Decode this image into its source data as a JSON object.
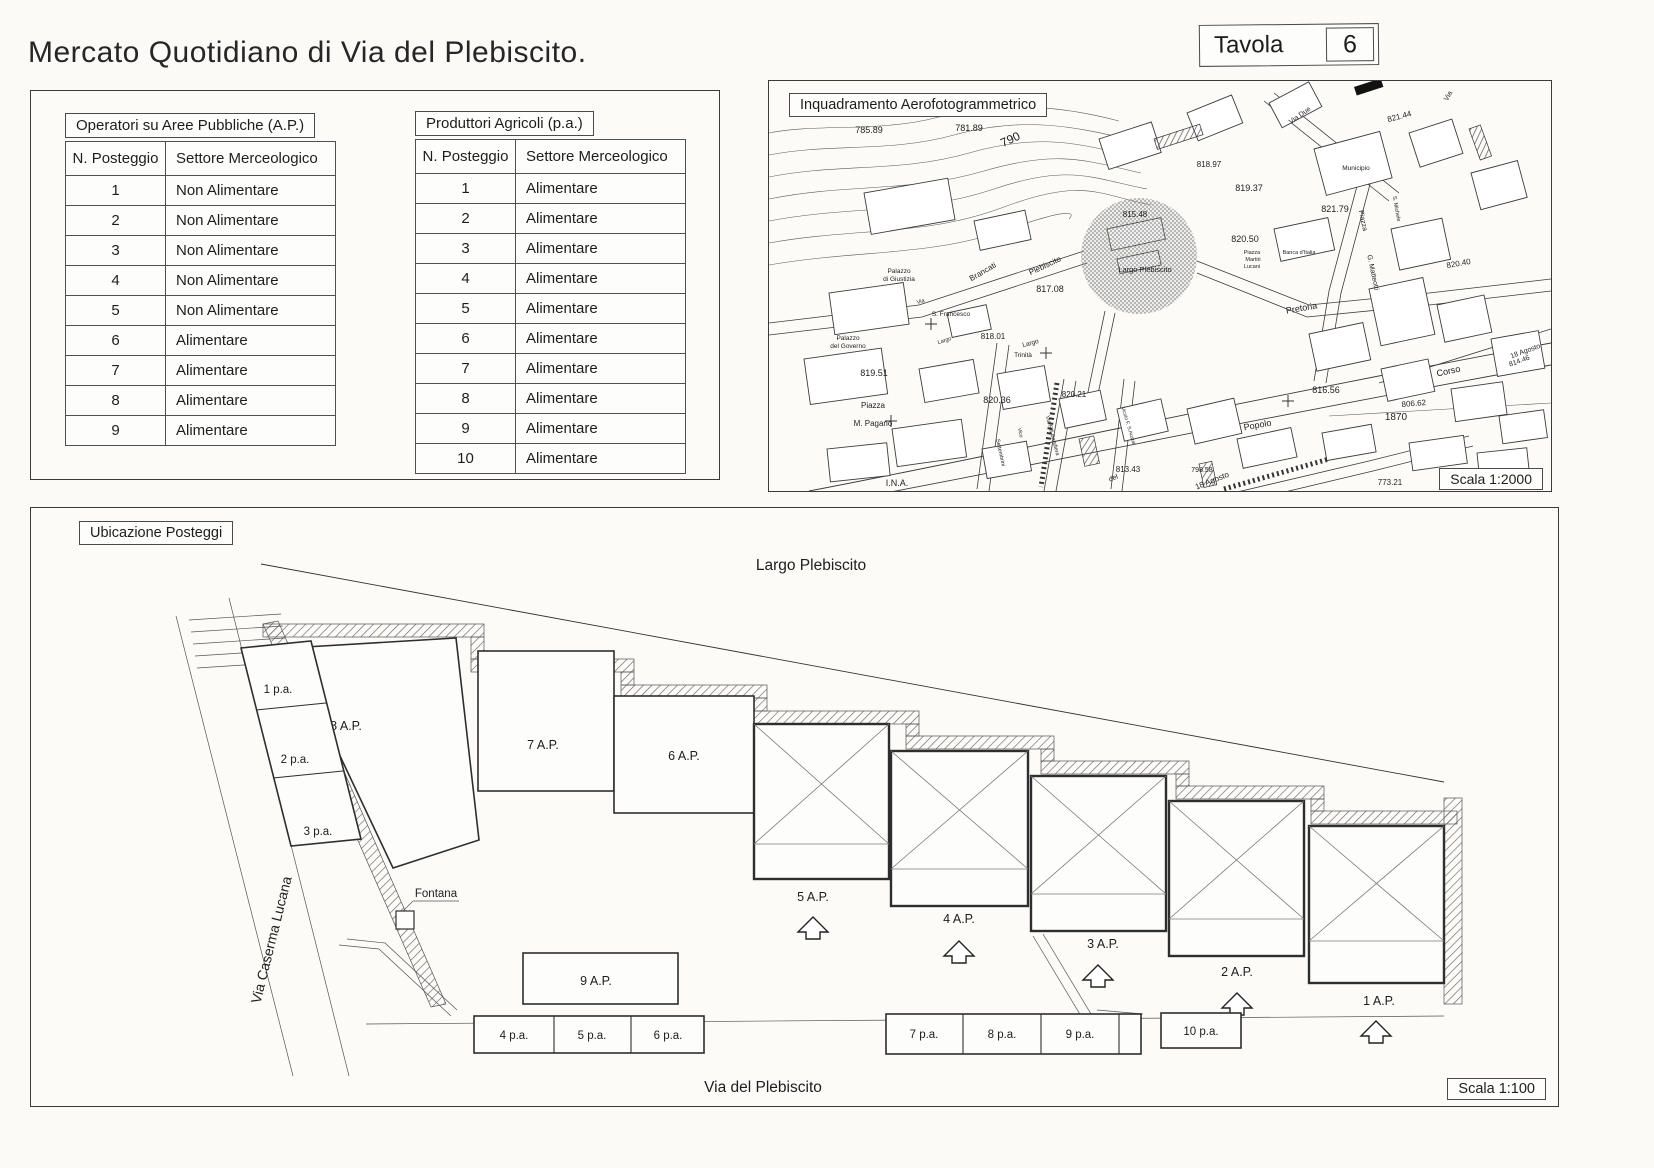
{
  "page": {
    "title": "Mercato Quotidiano di Via del Plebiscito.",
    "tavola_label": "Tavola",
    "tavola_number": "6"
  },
  "colors": {
    "paper": "#fbfaf7",
    "ink": "#1d1d1d"
  },
  "tables": {
    "ap": {
      "title": "Operatori su Aree Pubbliche  (A.P.)",
      "headers": [
        "N. Posteggio",
        "Settore Merceologico"
      ],
      "rows": [
        [
          "1",
          "Non Alimentare"
        ],
        [
          "2",
          "Non Alimentare"
        ],
        [
          "3",
          "Non Alimentare"
        ],
        [
          "4",
          "Non Alimentare"
        ],
        [
          "5",
          "Non Alimentare"
        ],
        [
          "6",
          "Alimentare"
        ],
        [
          "7",
          "Alimentare"
        ],
        [
          "8",
          "Alimentare"
        ],
        [
          "9",
          "Alimentare"
        ]
      ]
    },
    "pa": {
      "title": "Produttori Agricoli  (p.a.)",
      "headers": [
        "N. Posteggio",
        "Settore Merceologico"
      ],
      "rows": [
        [
          "1",
          "Alimentare"
        ],
        [
          "2",
          "Alimentare"
        ],
        [
          "3",
          "Alimentare"
        ],
        [
          "4",
          "Alimentare"
        ],
        [
          "5",
          "Alimentare"
        ],
        [
          "6",
          "Alimentare"
        ],
        [
          "7",
          "Alimentare"
        ],
        [
          "8",
          "Alimentare"
        ],
        [
          "9",
          "Alimentare"
        ],
        [
          "10",
          "Alimentare"
        ]
      ]
    }
  },
  "map": {
    "title": "Inquadramento Aerofotogrammetrico",
    "scale_label": "Scala 1:2000",
    "labels": [
      {
        "t": "785.89",
        "x": 100,
        "y": 52,
        "s": 9
      },
      {
        "t": "781.89",
        "x": 200,
        "y": 50,
        "s": 9
      },
      {
        "t": "790",
        "x": 243,
        "y": 62,
        "s": 12,
        "r": -25
      },
      {
        "t": "818.97",
        "x": 440,
        "y": 86,
        "s": 8
      },
      {
        "t": "819.37",
        "x": 480,
        "y": 110,
        "s": 9
      },
      {
        "t": "815.48",
        "x": 366,
        "y": 136,
        "s": 8
      },
      {
        "t": "820.50",
        "x": 476,
        "y": 161,
        "s": 9
      },
      {
        "t": "Piazza",
        "x": 483,
        "y": 173,
        "s": 5.5
      },
      {
        "t": "Martiri",
        "x": 484,
        "y": 180,
        "s": 5.5
      },
      {
        "t": "Lucani",
        "x": 483,
        "y": 187,
        "s": 5.5
      },
      {
        "t": "Banca d'Italia",
        "x": 530,
        "y": 173,
        "s": 5.5
      },
      {
        "t": "Largo Plebiscito",
        "x": 376,
        "y": 191,
        "s": 7.5
      },
      {
        "t": "Plebiscito",
        "x": 277,
        "y": 187,
        "s": 8,
        "r": -25
      },
      {
        "t": "Brancati",
        "x": 215,
        "y": 193,
        "s": 8,
        "r": -30
      },
      {
        "t": "Palazzo",
        "x": 130,
        "y": 192,
        "s": 6.5
      },
      {
        "t": "di Giustizia",
        "x": 130,
        "y": 200,
        "s": 6.5
      },
      {
        "t": "Via",
        "x": 152,
        "y": 222,
        "s": 5.5,
        "r": -15
      },
      {
        "t": "S. Francesco",
        "x": 182,
        "y": 235,
        "s": 6.5
      },
      {
        "t": "Palazzo",
        "x": 79,
        "y": 259,
        "s": 6.5
      },
      {
        "t": "del Governo",
        "x": 79,
        "y": 267,
        "s": 6.5
      },
      {
        "t": "Largo",
        "x": 176,
        "y": 261,
        "s": 5.5,
        "r": -18
      },
      {
        "t": "818.01",
        "x": 224,
        "y": 258,
        "s": 8
      },
      {
        "t": "Largo",
        "x": 262,
        "y": 264,
        "s": 6.5,
        "r": -15
      },
      {
        "t": "Trinità",
        "x": 254,
        "y": 276,
        "s": 6.5
      },
      {
        "t": "817.08",
        "x": 281,
        "y": 211,
        "s": 9
      },
      {
        "t": "819.51",
        "x": 105,
        "y": 295,
        "s": 9
      },
      {
        "t": "Piazza",
        "x": 104,
        "y": 327,
        "s": 8
      },
      {
        "t": "M. Pagano",
        "x": 104,
        "y": 345,
        "s": 8
      },
      {
        "t": "820.36",
        "x": 228,
        "y": 322,
        "s": 9
      },
      {
        "t": "820.21",
        "x": 305,
        "y": 316,
        "s": 8
      },
      {
        "t": "Via F.lli Bandiera",
        "x": 282,
        "y": 355,
        "s": 5.5,
        "r": 75
      },
      {
        "t": "Vico",
        "x": 250,
        "y": 352,
        "s": 5,
        "r": 78
      },
      {
        "t": "Settembrini",
        "x": 230,
        "y": 372,
        "s": 5.5,
        "r": 78
      },
      {
        "t": "Vicolo F. S.Austai",
        "x": 358,
        "y": 345,
        "s": 5,
        "r": 73
      },
      {
        "t": "813.43",
        "x": 359,
        "y": 391,
        "s": 8
      },
      {
        "t": "del",
        "x": 345,
        "y": 399,
        "s": 7,
        "r": -20
      },
      {
        "t": "Popolo",
        "x": 489,
        "y": 347,
        "s": 9,
        "r": -10
      },
      {
        "t": "816.56",
        "x": 557,
        "y": 312,
        "s": 9
      },
      {
        "t": "806.62",
        "x": 645,
        "y": 325,
        "s": 8,
        "r": -5
      },
      {
        "t": "1870",
        "x": 627,
        "y": 339,
        "s": 10
      },
      {
        "t": "Corso",
        "x": 680,
        "y": 293,
        "s": 9,
        "r": -12
      },
      {
        "t": "18 Agosto",
        "x": 757,
        "y": 272,
        "s": 7,
        "r": -20
      },
      {
        "t": "814.46",
        "x": 751,
        "y": 282,
        "s": 7,
        "r": -20
      },
      {
        "t": "18 Agosto",
        "x": 444,
        "y": 402,
        "s": 8,
        "r": -22
      },
      {
        "t": "798.58",
        "x": 433,
        "y": 391,
        "s": 7
      },
      {
        "t": "773.21",
        "x": 621,
        "y": 404,
        "s": 8
      },
      {
        "t": "I.N.A.",
        "x": 128,
        "y": 405,
        "s": 9
      },
      {
        "t": "Pretoria",
        "x": 533,
        "y": 230,
        "s": 9,
        "r": -10
      },
      {
        "t": "Municipio",
        "x": 587,
        "y": 89,
        "s": 6.5
      },
      {
        "t": "Piazza",
        "x": 592,
        "y": 140,
        "s": 7,
        "r": 78
      },
      {
        "t": "G. Matteotti",
        "x": 602,
        "y": 192,
        "s": 7,
        "r": 78
      },
      {
        "t": "821.79",
        "x": 566,
        "y": 131,
        "s": 9
      },
      {
        "t": "821.44",
        "x": 631,
        "y": 38,
        "s": 8,
        "r": -15
      },
      {
        "t": "820.40",
        "x": 690,
        "y": 185,
        "s": 8,
        "r": -10
      },
      {
        "t": "S. Michele",
        "x": 626,
        "y": 128,
        "s": 5.5,
        "r": 80
      },
      {
        "t": "Via Due",
        "x": 532,
        "y": 36,
        "s": 7,
        "r": -35
      },
      {
        "t": "Via",
        "x": 681,
        "y": 16,
        "s": 7,
        "r": -60
      }
    ]
  },
  "plan": {
    "box_label": "Ubicazione Posteggi",
    "scale_label": "Scala 1:100",
    "largo_label": "Largo Plebiscito",
    "via_bottom_label": "Via del Plebiscito",
    "via_left_label": "Via Caserma Lucana",
    "fountain_label": "Fontana",
    "stalls_plain": [
      {
        "id": "8ap",
        "label": "8 A.P.",
        "poly": [
          [
            258,
            140
          ],
          [
            425,
            130
          ],
          [
            448,
            332
          ],
          [
            362,
            360
          ]
        ],
        "lx": 315,
        "ly": 222
      },
      {
        "id": "7ap",
        "label": "7 A.P.",
        "rect": [
          447,
          143,
          136,
          140
        ],
        "lx": 512,
        "ly": 241
      },
      {
        "id": "6ap",
        "label": "6 A.P.",
        "rect": [
          583,
          188,
          140,
          117
        ],
        "lx": 653,
        "ly": 252
      },
      {
        "id": "9ap",
        "label": "9 A.P.",
        "rect": [
          492,
          445,
          155,
          51
        ],
        "lx": 565,
        "ly": 477
      }
    ],
    "stalls_crossed": [
      {
        "id": "5ap",
        "label": "5 A.P.",
        "rect": [
          723,
          216,
          135,
          155
        ],
        "inner": 336,
        "lx": 782,
        "ly": 393,
        "ax": 782,
        "ay": 418
      },
      {
        "id": "4ap",
        "label": "4 A.P.",
        "rect": [
          860,
          243,
          137,
          155
        ],
        "inner": 361,
        "lx": 928,
        "ly": 415,
        "ax": 928,
        "ay": 442
      },
      {
        "id": "3ap",
        "label": "3 A.P.",
        "rect": [
          1000,
          268,
          135,
          155
        ],
        "inner": 386,
        "lx": 1072,
        "ly": 440,
        "ax": 1067,
        "ay": 466
      },
      {
        "id": "2ap",
        "label": "2 A.P.",
        "rect": [
          1138,
          293,
          135,
          155
        ],
        "inner": 411,
        "lx": 1206,
        "ly": 468,
        "ax": 1206,
        "ay": 494
      },
      {
        "id": "1ap",
        "label": "1 A.P.",
        "rect": [
          1278,
          318,
          135,
          157
        ],
        "inner": 433,
        "lx": 1348,
        "ly": 497,
        "ax": 1345,
        "ay": 522
      }
    ],
    "pa_left": {
      "poly": [
        [
          210,
          140
        ],
        [
          280,
          133
        ],
        [
          330,
          331
        ],
        [
          260,
          338
        ]
      ],
      "dividers": [
        [
          225,
          202,
          295,
          195
        ],
        [
          242,
          270,
          312,
          263
        ]
      ],
      "cells": [
        {
          "label": "1 p.a.",
          "lx": 247,
          "ly": 185
        },
        {
          "label": "2 p.a.",
          "lx": 264,
          "ly": 255
        },
        {
          "label": "3 p.a.",
          "lx": 287,
          "ly": 327
        }
      ]
    },
    "pa_strips": [
      {
        "x": 443,
        "y": 508,
        "w": 230,
        "h": 37,
        "dividers": [
          523,
          600
        ],
        "cells": [
          {
            "label": "4 p.a.",
            "lx": 483,
            "ly": 531
          },
          {
            "label": "5 p.a.",
            "lx": 561,
            "ly": 531
          },
          {
            "label": "6 p.a.",
            "lx": 637,
            "ly": 531
          }
        ]
      },
      {
        "x": 855,
        "y": 506,
        "w": 255,
        "h": 40,
        "dividers": [
          932,
          1010,
          1088
        ],
        "cells": [
          {
            "label": "7 p.a.",
            "lx": 893,
            "ly": 530
          },
          {
            "label": "8 p.a.",
            "lx": 971,
            "ly": 530
          },
          {
            "label": "9 p.a.",
            "lx": 1049,
            "ly": 530
          }
        ]
      },
      {
        "x": 1130,
        "y": 505,
        "w": 80,
        "h": 35,
        "dividers": [],
        "cells": [
          {
            "label": "10 p.a.",
            "lx": 1170,
            "ly": 527
          }
        ]
      }
    ]
  }
}
